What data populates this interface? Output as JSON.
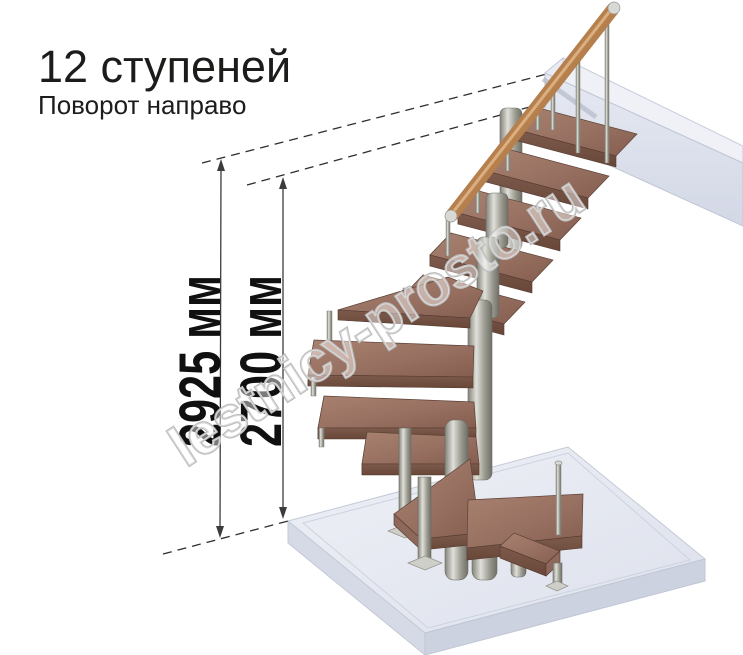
{
  "header": {
    "title": "12 ступеней",
    "subtitle": "Поворот направо"
  },
  "dimensions": {
    "overall_height": "2925 мм",
    "floor_to_top_step": "2700 мм"
  },
  "watermark": "lestnicy-prosto.ru",
  "staircase": {
    "steps_count": 12,
    "turn": "направо",
    "colors": {
      "wood_top": "#9a7366",
      "wood_front": "#7b584b",
      "handrail": "#a9744b",
      "metal_light": "#dcdcd6",
      "metal_dark": "#7a7a72",
      "slab": "#e7eaf2",
      "dimension_line": "#3c3c3c",
      "text": "#1c1c1b",
      "watermark_outline": "#bcbcbc"
    }
  }
}
